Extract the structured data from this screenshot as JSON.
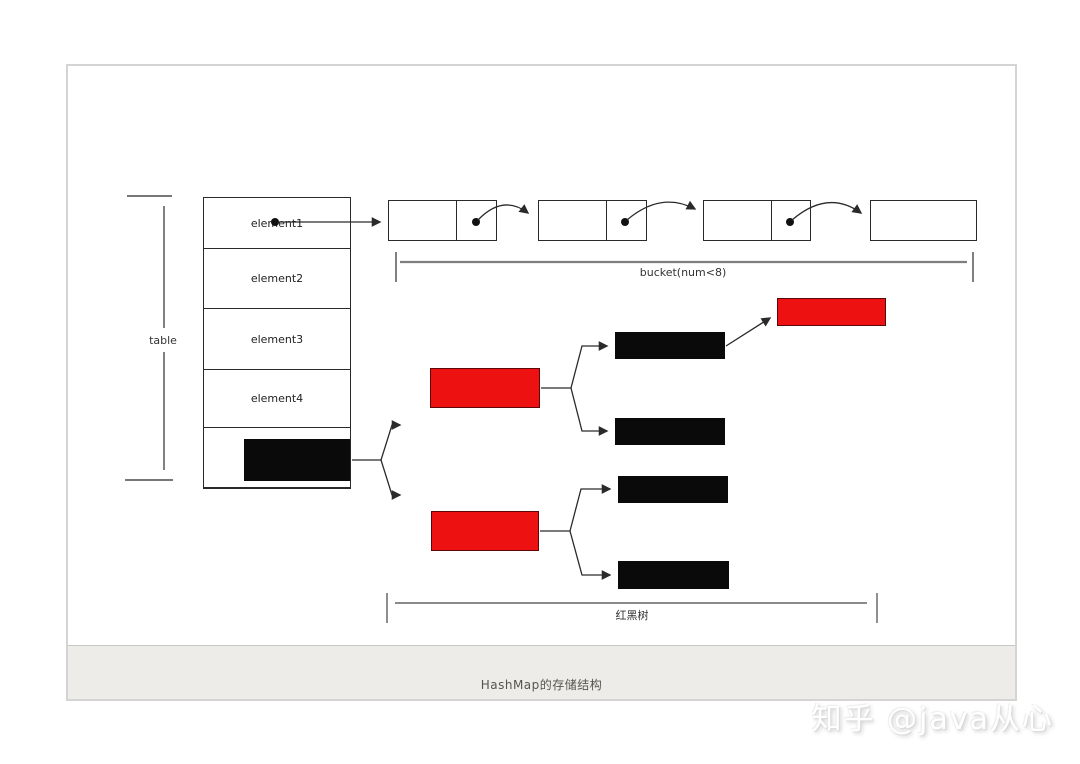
{
  "page": {
    "caption": "HashMap的存储结构",
    "watermark": "知乎 @java从心"
  },
  "table": {
    "bracket_label": "table",
    "rows": [
      "element1",
      "element2",
      "element3",
      "element4"
    ]
  },
  "bucket": {
    "label": "bucket(num<8)"
  },
  "rbtree": {
    "label": "红黑树"
  },
  "colors": {
    "node_red": "#ee1111",
    "node_black": "#0a0a0a",
    "line": "#2a2a2a",
    "bucket_line": "#7f7f7f",
    "footer_bg": "#edece8",
    "panel_border": "#d4d4d2"
  }
}
